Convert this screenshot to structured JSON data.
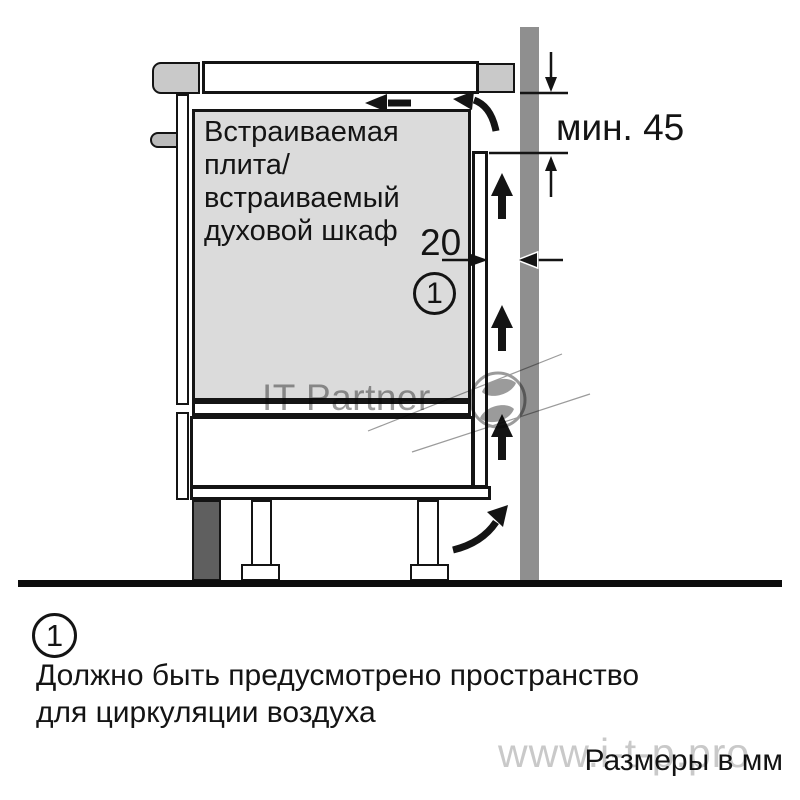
{
  "diagram": {
    "appliance_label": "Встраиваемая\nплита/\nвстраиваемый\nдуховой шкаф",
    "dim_min45": "мин. 45",
    "dim_20": "20",
    "callout": "1"
  },
  "footnote": {
    "marker": "1",
    "text": "Должно быть предусмотрено пространство\nдля циркуляции воздуха"
  },
  "units_label": "Размеры в мм",
  "watermark": {
    "name": "IT Partner",
    "site": "www.i-t-p.pro"
  },
  "colors": {
    "outline": "#141414",
    "wall_gray": "#8f8f8f",
    "appliance_fill": "#dbdbdb",
    "counter_edge_gray": "#c9c9c9",
    "handle_gray": "#bbbbbb",
    "plinth_dark_gray": "#5f5f5f",
    "watermark_gray": "#9c9c9c",
    "watermark_light_gray": "#c9c9c9"
  }
}
